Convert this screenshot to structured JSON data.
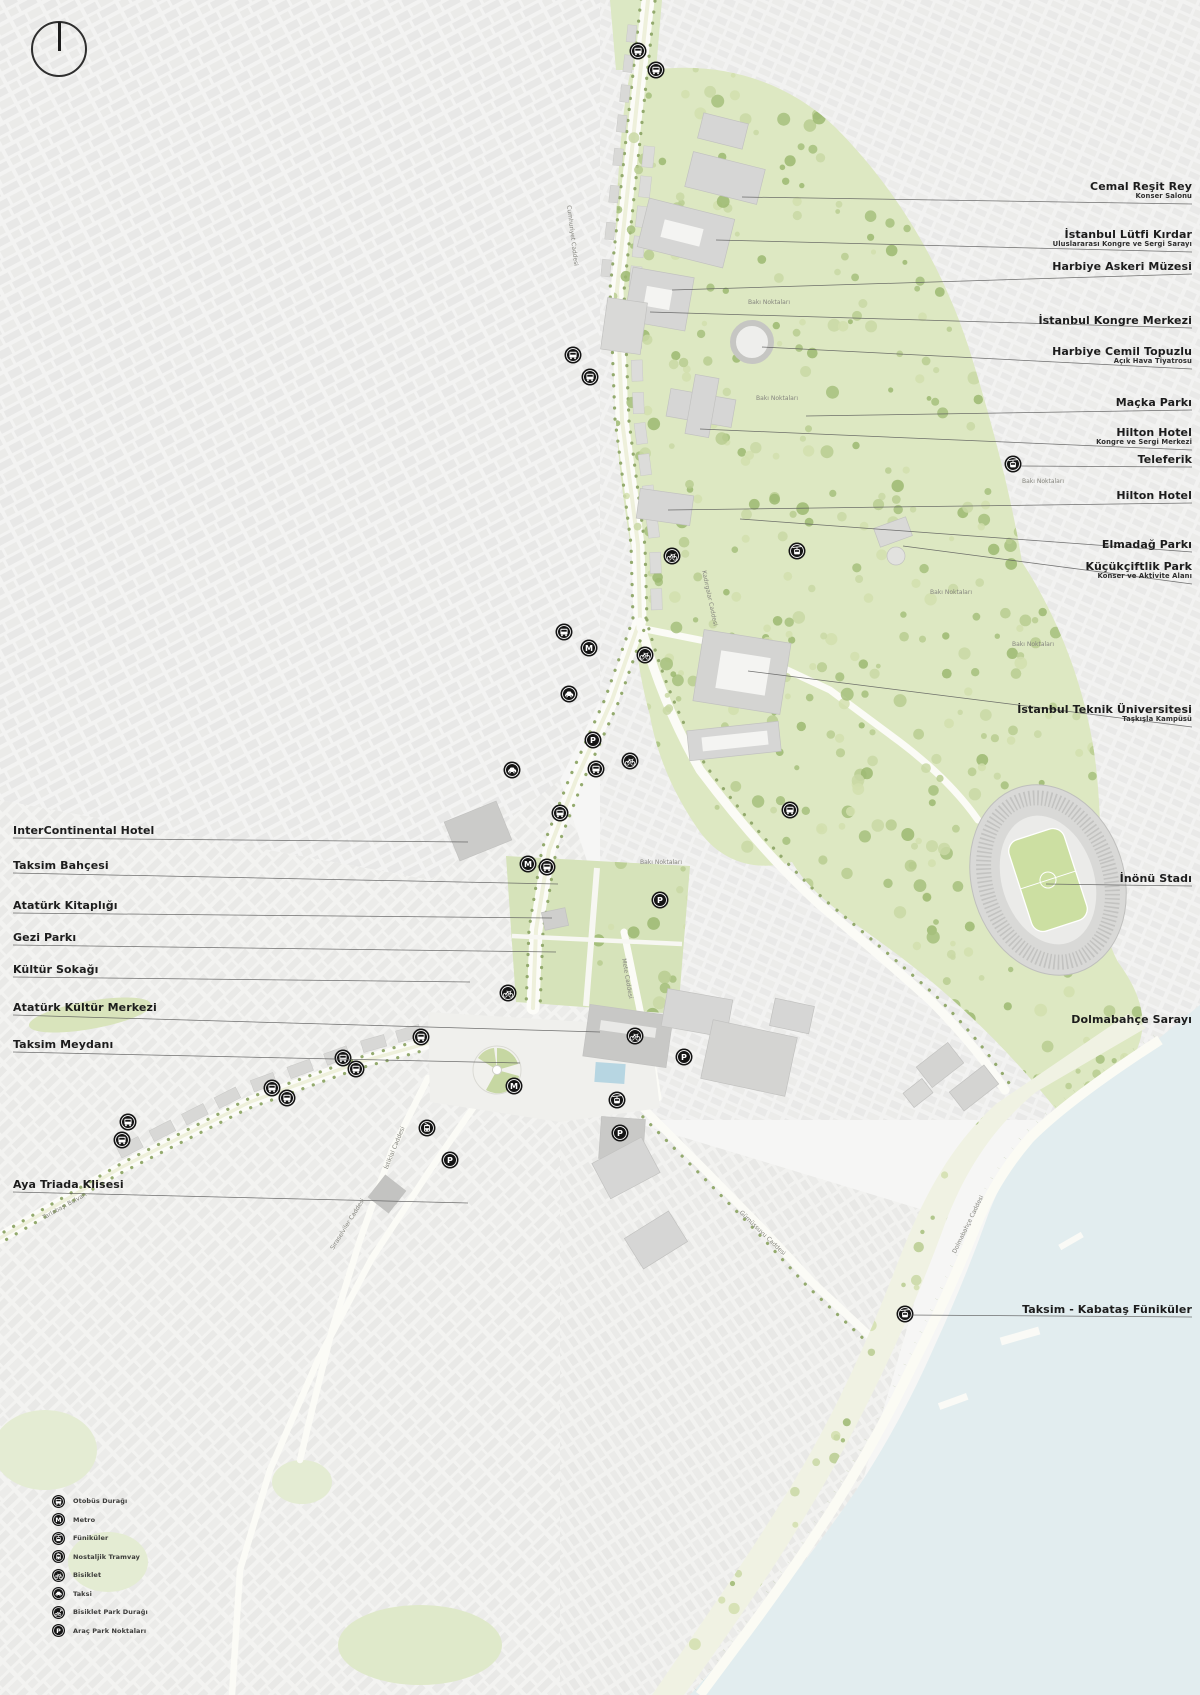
{
  "map_title": "Taksim - Maçka bölgesi vaziyet planı",
  "colors": {
    "water": "#e2edef",
    "park_base": "#dde8c2",
    "gezi_park": "#d6e3ba",
    "coast_band": "#f0f2e3",
    "road": "#fcfcf8",
    "tree_greens": [
      "#c9d8a4",
      "#b9cd90",
      "#a6c07c",
      "#d2dfae",
      "#9cb871"
    ],
    "marker_black": "#141414",
    "label_text": "#1c1c1c",
    "leader_line": "#5a5a5a",
    "pitch_green": "#ccdfa2",
    "pool_blue": "#b7d6e2"
  },
  "compass": {
    "name": "north-indicator"
  },
  "right_labels": [
    {
      "title": "Cemal Reşit Rey",
      "sub": "Konser Salonu",
      "top": 181,
      "line_y": 204,
      "tx": 742,
      "ty": 197
    },
    {
      "title": "İstanbul Lütfi Kırdar",
      "sub": "Uluslararası Kongre ve Sergi Sarayı",
      "top": 229,
      "line_y": 252,
      "tx": 716,
      "ty": 240
    },
    {
      "title": "Harbiye Askeri Müzesi",
      "sub": "",
      "top": 261,
      "line_y": 274,
      "tx": 672,
      "ty": 290
    },
    {
      "title": "İstanbul Kongre Merkezi",
      "sub": "",
      "top": 315,
      "line_y": 328,
      "tx": 650,
      "ty": 312
    },
    {
      "title": "Harbiye Cemil Topuzlu",
      "sub": "Açık Hava Tiyatrosu",
      "top": 346,
      "line_y": 369,
      "tx": 762,
      "ty": 347
    },
    {
      "title": "Maçka Parkı",
      "sub": "",
      "top": 397,
      "line_y": 410,
      "tx": 806,
      "ty": 416
    },
    {
      "title": "Hilton Hotel",
      "sub": "Kongre ve Sergi Merkezi",
      "top": 427,
      "line_y": 450,
      "tx": 700,
      "ty": 429
    },
    {
      "title": "Teleferik",
      "sub": "",
      "top": 454,
      "line_y": 467,
      "tx": 1021,
      "ty": 466
    },
    {
      "title": "Hilton Hotel",
      "sub": "",
      "top": 490,
      "line_y": 503,
      "tx": 668,
      "ty": 510
    },
    {
      "title": "Elmadağ Parkı",
      "sub": "",
      "top": 539,
      "line_y": 552,
      "tx": 740,
      "ty": 519
    },
    {
      "title": "Küçükçiftlik Park",
      "sub": "Konser ve Aktivite Alanı",
      "top": 561,
      "line_y": 584,
      "tx": 903,
      "ty": 546
    },
    {
      "title": "İstanbul Teknik Üniversitesi",
      "sub": "Taşkışla Kampüsü",
      "top": 704,
      "line_y": 727,
      "tx": 748,
      "ty": 671
    },
    {
      "title": "İnönü Stadı",
      "sub": "",
      "top": 873,
      "line_y": 886,
      "tx": 1046,
      "ty": 884
    },
    {
      "title": "Dolmabahçe Sarayı",
      "sub": "",
      "top": 1014,
      "line_y": null,
      "tx": null,
      "ty": null
    },
    {
      "title": "Taksim - Kabataş Füniküler",
      "sub": "",
      "top": 1304,
      "line_y": 1317,
      "tx": 908,
      "ty": 1315
    }
  ],
  "left_labels": [
    {
      "title": "InterContinental Hotel",
      "top": 825,
      "line_y": 838,
      "tx": 468,
      "ty": 842
    },
    {
      "title": "Taksim Bahçesi",
      "top": 860,
      "line_y": 873,
      "tx": 558,
      "ty": 884
    },
    {
      "title": "Atatürk Kitaplığı",
      "top": 900,
      "line_y": 913,
      "tx": 552,
      "ty": 918
    },
    {
      "title": "Gezi Parkı",
      "top": 932,
      "line_y": 945,
      "tx": 556,
      "ty": 952
    },
    {
      "title": "Kültür Sokağı",
      "top": 964,
      "line_y": 977,
      "tx": 470,
      "ty": 982
    },
    {
      "title": "Atatürk Kültür Merkezi",
      "top": 1002,
      "line_y": 1015,
      "tx": 600,
      "ty": 1032
    },
    {
      "title": "Taksim Meydanı",
      "top": 1039,
      "line_y": 1052,
      "tx": 520,
      "ty": 1063
    },
    {
      "title": "Aya Triada Klisesi",
      "top": 1179,
      "line_y": 1192,
      "tx": 468,
      "ty": 1203
    }
  ],
  "small_labels": [
    {
      "text": "Cumhuriyet Caddesi",
      "x": 571,
      "y": 205,
      "rot": 83
    },
    {
      "text": "Bakı Noktaları",
      "x": 748,
      "y": 300,
      "rot": 0
    },
    {
      "text": "Bakı Noktaları",
      "x": 756,
      "y": 396,
      "rot": 0
    },
    {
      "text": "Bakı Noktaları",
      "x": 1022,
      "y": 479,
      "rot": 0
    },
    {
      "text": "Bakı Noktaları",
      "x": 930,
      "y": 590,
      "rot": 0
    },
    {
      "text": "Bakı Noktaları",
      "x": 1012,
      "y": 642,
      "rot": 0
    },
    {
      "text": "Bakı Noktaları",
      "x": 640,
      "y": 860,
      "rot": 0
    },
    {
      "text": "Kadırgalar Caddesi",
      "x": 706,
      "y": 570,
      "rot": 78
    },
    {
      "text": "Mete Caddesi",
      "x": 626,
      "y": 958,
      "rot": 80
    },
    {
      "text": "Tarlabaşı Bulvarı",
      "x": 42,
      "y": 1216,
      "rot": -29
    },
    {
      "text": "İstiklal Caddesi",
      "x": 384,
      "y": 1168,
      "rot": -68
    },
    {
      "text": "Sıraselviler Caddesi",
      "x": 330,
      "y": 1248,
      "rot": -58
    },
    {
      "text": "Gümüşsuyu Caddesi",
      "x": 742,
      "y": 1210,
      "rot": 44
    },
    {
      "text": "Dolmabahçe Caddesi",
      "x": 952,
      "y": 1252,
      "rot": -64
    }
  ],
  "legend": {
    "items": [
      {
        "icon": "bus",
        "label": "Otobüs Durağı"
      },
      {
        "icon": "metro",
        "label": "Metro"
      },
      {
        "icon": "funicular",
        "label": "Füniküler"
      },
      {
        "icon": "tram",
        "label": "Nostaljik Tramvay"
      },
      {
        "icon": "bike",
        "label": "Bisiklet"
      },
      {
        "icon": "taxi",
        "label": "Taksi"
      },
      {
        "icon": "bikepark",
        "label": "Bisiklet Park Durağı"
      },
      {
        "icon": "parking",
        "label": "Araç Park Noktaları"
      }
    ]
  },
  "markers": [
    {
      "icon": "bus",
      "x": 638,
      "y": 51
    },
    {
      "icon": "bus",
      "x": 656,
      "y": 70
    },
    {
      "icon": "bus",
      "x": 573,
      "y": 355
    },
    {
      "icon": "bus",
      "x": 590,
      "y": 377
    },
    {
      "icon": "bus",
      "x": 564,
      "y": 632
    },
    {
      "icon": "metro",
      "x": 589,
      "y": 648
    },
    {
      "icon": "bike",
      "x": 645,
      "y": 655
    },
    {
      "icon": "bike",
      "x": 672,
      "y": 556
    },
    {
      "icon": "funicular",
      "x": 1013,
      "y": 464
    },
    {
      "icon": "funicular",
      "x": 797,
      "y": 551
    },
    {
      "icon": "taxi",
      "x": 569,
      "y": 694
    },
    {
      "icon": "parking",
      "x": 593,
      "y": 740
    },
    {
      "icon": "taxi",
      "x": 512,
      "y": 770
    },
    {
      "icon": "bus",
      "x": 596,
      "y": 769
    },
    {
      "icon": "bike",
      "x": 630,
      "y": 761
    },
    {
      "icon": "bus",
      "x": 790,
      "y": 810
    },
    {
      "icon": "bus",
      "x": 560,
      "y": 813
    },
    {
      "icon": "bus",
      "x": 547,
      "y": 867
    },
    {
      "icon": "metro",
      "x": 528,
      "y": 864
    },
    {
      "icon": "parking",
      "x": 660,
      "y": 900
    },
    {
      "icon": "bike",
      "x": 508,
      "y": 993
    },
    {
      "icon": "bike",
      "x": 635,
      "y": 1036
    },
    {
      "icon": "metro",
      "x": 514,
      "y": 1086
    },
    {
      "icon": "funicular",
      "x": 617,
      "y": 1100
    },
    {
      "icon": "parking",
      "x": 684,
      "y": 1057
    },
    {
      "icon": "bus",
      "x": 421,
      "y": 1037
    },
    {
      "icon": "bus",
      "x": 343,
      "y": 1058
    },
    {
      "icon": "bus",
      "x": 356,
      "y": 1069
    },
    {
      "icon": "bus",
      "x": 272,
      "y": 1088
    },
    {
      "icon": "bus",
      "x": 287,
      "y": 1098
    },
    {
      "icon": "bus",
      "x": 128,
      "y": 1122
    },
    {
      "icon": "bus",
      "x": 122,
      "y": 1140
    },
    {
      "icon": "tram",
      "x": 427,
      "y": 1128
    },
    {
      "icon": "parking",
      "x": 620,
      "y": 1133
    },
    {
      "icon": "parking",
      "x": 450,
      "y": 1160
    },
    {
      "icon": "funicular",
      "x": 905,
      "y": 1314
    }
  ]
}
